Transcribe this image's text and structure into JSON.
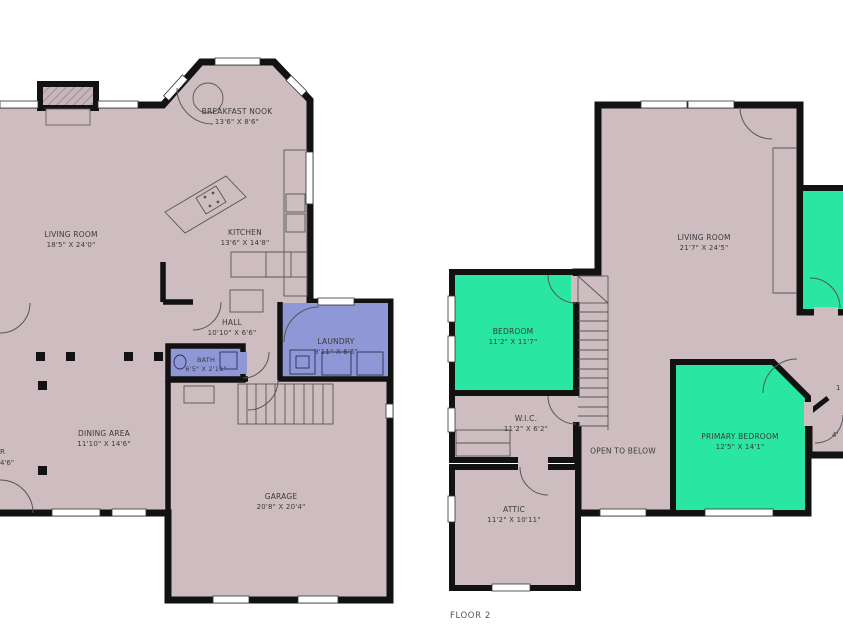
{
  "colors": {
    "wall": "#121212",
    "room_fill": "#cebdc0",
    "bedroom_green": "#29e7a2",
    "utility_blue": "#9097d6",
    "label_text": "#3a3a3a",
    "caption_text": "#555555",
    "background": "#ffffff"
  },
  "floor1": {
    "rooms": {
      "living_room": {
        "name": "LIVING ROOM",
        "dims": "18'5\" X 24'0\""
      },
      "breakfast_nook": {
        "name": "BREAKFAST NOOK",
        "dims": "13'6\" X 8'6\""
      },
      "kitchen": {
        "name": "KITCHEN",
        "dims": "13'6\" X 14'8\""
      },
      "hall": {
        "name": "HALL",
        "dims": "10'10\" X 6'6\""
      },
      "laundry": {
        "name": "LAUNDRY",
        "dims": "9'11\" X 6'6\""
      },
      "bath": {
        "name": "BATH",
        "dims": "6'5\" X 2'11\""
      },
      "dining_area": {
        "name": "DINING AREA",
        "dims": "11'10\" X 14'6\""
      },
      "garage": {
        "name": "GARAGE",
        "dims": "20'8\" X 20'4\""
      }
    },
    "edge_fragments": {
      "line1": "R",
      "line2": "4'6\""
    }
  },
  "floor2": {
    "caption": "FLOOR 2",
    "rooms": {
      "living_room": {
        "name": "LIVING ROOM",
        "dims": "21'7\" X 24'5\""
      },
      "bedroom": {
        "name": "BEDROOM",
        "dims": "11'2\" X 11'7\""
      },
      "wic": {
        "name": "W.I.C.",
        "dims": "11'2\" X 6'2\""
      },
      "open_to_below": {
        "name": "OPEN TO BELOW"
      },
      "primary_bedroom": {
        "name": "PRIMARY BEDROOM",
        "dims": "12'5\" X 14'1\""
      },
      "attic": {
        "name": "ATTIC",
        "dims": "11'2\" X 10'11\""
      }
    },
    "edge_fragments": {
      "line1": "1",
      "line2": "4'"
    }
  }
}
